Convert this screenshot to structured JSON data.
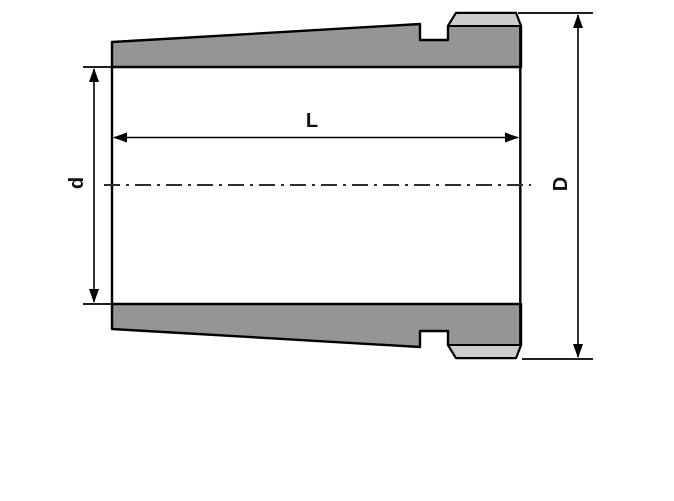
{
  "diagram": {
    "type": "technical-drawing",
    "labels": {
      "length": "L",
      "inner_diameter": "d",
      "outer_diameter": "D"
    }
  },
  "colors": {
    "part_fill": "#959595",
    "chamfer_fill": "#cccccc",
    "outline": "#000000",
    "centerline": "#2e2e2e",
    "background": "#ffffff"
  }
}
